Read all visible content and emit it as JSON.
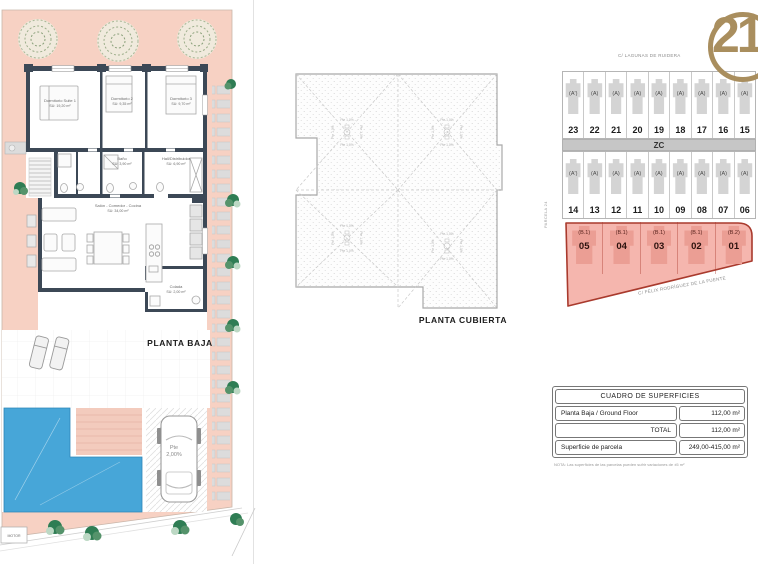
{
  "floor_plan": {
    "title": "PLANTA BAJA",
    "rooms": {
      "suite": {
        "name": "Dormitorio Suite 1",
        "area": "SU: 19,20 m²"
      },
      "dorm2": {
        "name": "Dormitorio 2",
        "area": "SU: 9,35 m²"
      },
      "dorm3": {
        "name": "Dormitorio 3",
        "area": "SU: 9,70 m²"
      },
      "bano": {
        "name": "Baño",
        "area": "SU: 3,90 m²"
      },
      "hall": {
        "name": "Hall/Distribuidor",
        "area": "SU: 6,90 m²"
      },
      "salon": {
        "name": "Salón - Comedor - Cocina",
        "area": "SU: 34,00 m²"
      },
      "colada": {
        "name": "Colada",
        "area": "SU: 2,00 m²"
      }
    },
    "pte_label": "Pte",
    "slope_value": "2,00%",
    "motor_label": "MOTOR"
  },
  "roof_plan": {
    "title": "PLANTA CUBIERTA",
    "slope": "Pte 1,0%"
  },
  "site_plan": {
    "street_top": "C/ LAGUNAS DE RUIDERA",
    "street_bottom": "C/ FÉLIX RODRÍGUEZ DE LA FUENTE",
    "parcel_label": "PARCELA 24",
    "zone_label": "ZC",
    "row1": [
      {
        "num": "23",
        "type": "(A')"
      },
      {
        "num": "22",
        "type": "(A)"
      },
      {
        "num": "21",
        "type": "(A)"
      },
      {
        "num": "20",
        "type": "(A)"
      },
      {
        "num": "19",
        "type": "(A)"
      },
      {
        "num": "18",
        "type": "(A)"
      },
      {
        "num": "17",
        "type": "(A)"
      },
      {
        "num": "16",
        "type": "(A)"
      },
      {
        "num": "15",
        "type": "(A)"
      }
    ],
    "row2": [
      {
        "num": "14",
        "type": "(A')"
      },
      {
        "num": "13",
        "type": "(A)"
      },
      {
        "num": "12",
        "type": "(A)"
      },
      {
        "num": "11",
        "type": "(A)"
      },
      {
        "num": "10",
        "type": "(A)"
      },
      {
        "num": "09",
        "type": "(A)"
      },
      {
        "num": "08",
        "type": "(A)"
      },
      {
        "num": "07",
        "type": "(A)"
      },
      {
        "num": "06",
        "type": "(A)"
      }
    ],
    "row3": [
      {
        "num": "05",
        "type": "(B.1)"
      },
      {
        "num": "04",
        "type": "(B.1)"
      },
      {
        "num": "03",
        "type": "(B.1)"
      },
      {
        "num": "02",
        "type": "(B.1)"
      },
      {
        "num": "01",
        "type": "(B.2)"
      }
    ]
  },
  "logo": {
    "text": "21"
  },
  "table": {
    "title": "CUADRO DE SUPERFICIES",
    "rows": [
      {
        "label": "Planta Baja / Ground Floor",
        "value": "112,00 m²"
      },
      {
        "label": "TOTAL",
        "value": "112,00 m²"
      },
      {
        "label": "Superficie de parcela",
        "value": "249,00-415,00 m²"
      }
    ],
    "note": "NOTA: Las superficies de las parcelas pueden sufrir variaciones de ±5 m²"
  },
  "colors": {
    "plot_pink": "#f7d1c3",
    "pool_blue": "#47a6d8",
    "wall_dark": "#3c4856",
    "highlight_red_fill": "#f5b6ae",
    "highlight_red_stroke": "#a93a2d",
    "logo_gold": "#a98e5e",
    "glyph_grey": "#d4d4d4"
  }
}
